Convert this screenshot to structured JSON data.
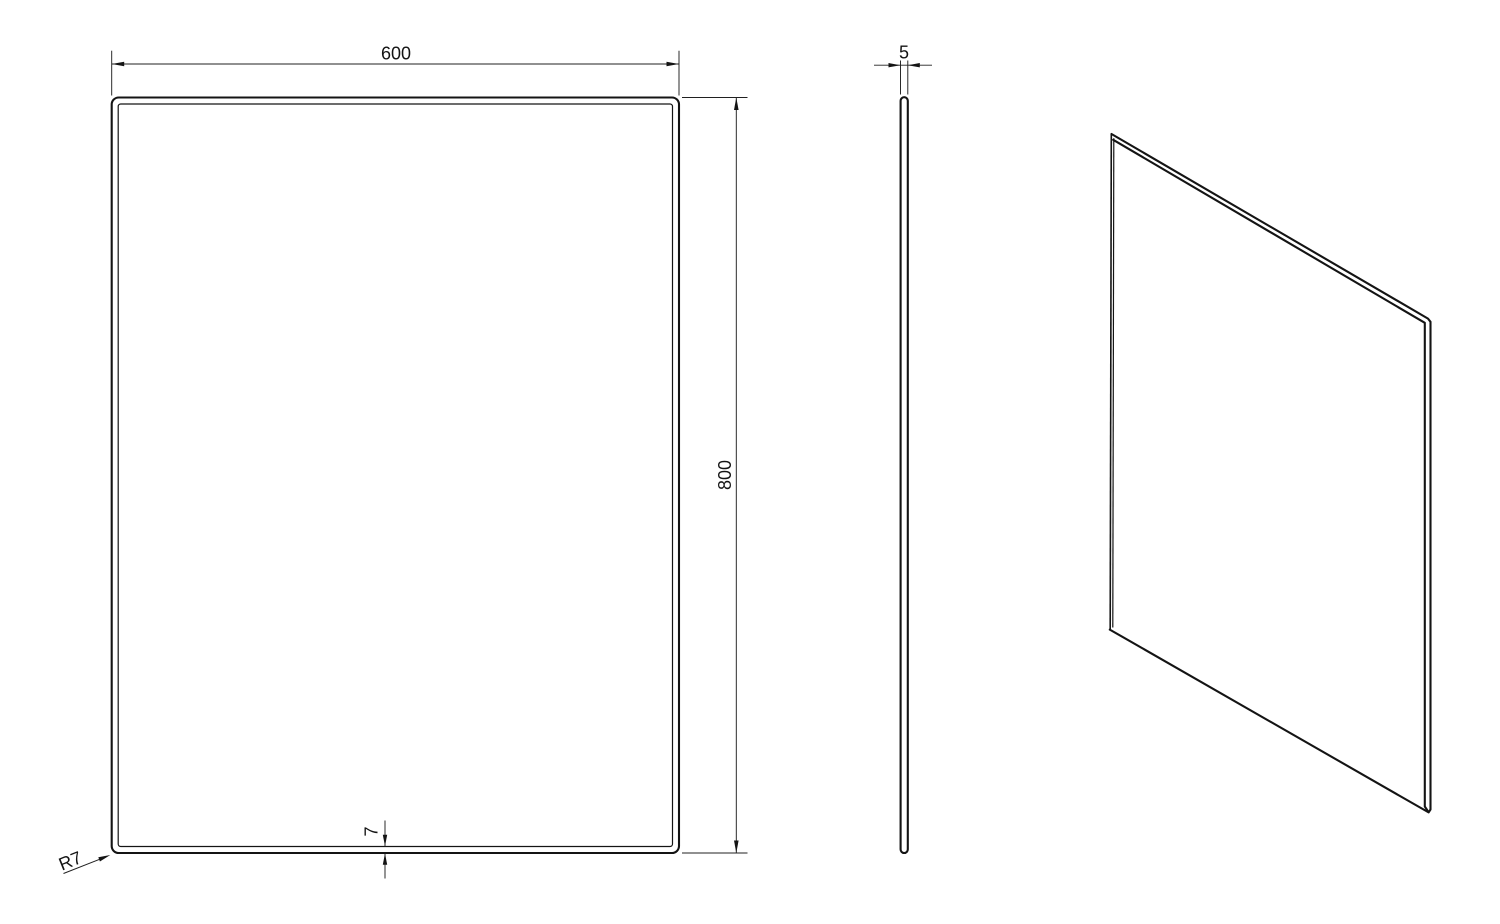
{
  "drawing": {
    "background_color": "#ffffff",
    "line_color": "#141414",
    "dimensions": {
      "width": "600",
      "height": "800",
      "thickness": "5",
      "bevel_width": "7",
      "corner_radius": "R7"
    }
  }
}
